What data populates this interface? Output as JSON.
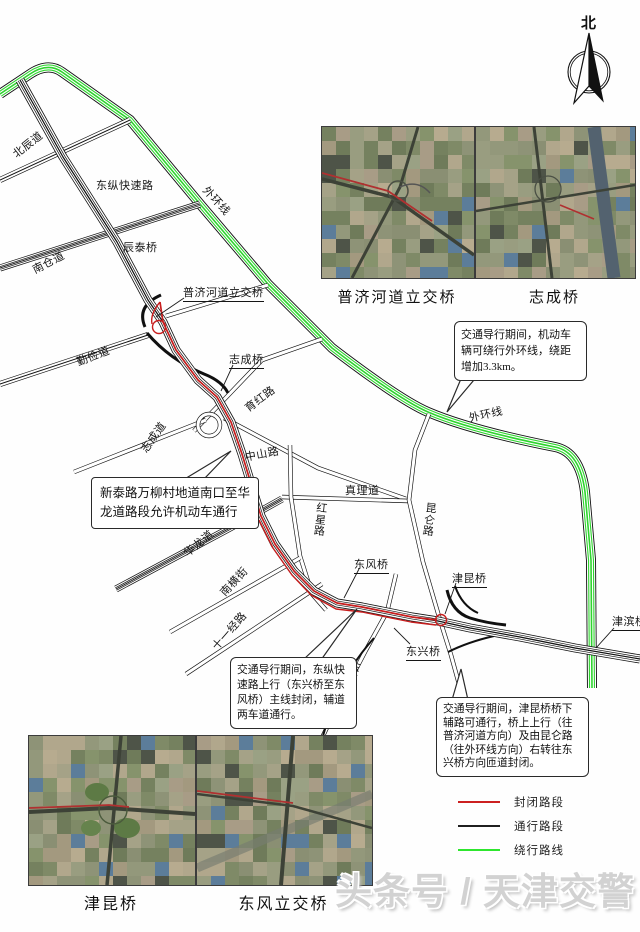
{
  "compass": {
    "north_label": "北"
  },
  "map": {
    "road_labels": [
      {
        "text": "北辰道"
      },
      {
        "text": "东纵快速路"
      },
      {
        "text": "外环线"
      },
      {
        "text": "辰泰桥"
      },
      {
        "text": "南仓道"
      },
      {
        "text": "普济河道立交桥"
      },
      {
        "text": "勤俭道"
      },
      {
        "text": "志成桥"
      },
      {
        "text": "育红路"
      },
      {
        "text": "志成道"
      },
      {
        "text": "中山路"
      },
      {
        "text": "真理道"
      },
      {
        "text": "红星路"
      },
      {
        "text": "昆仑路"
      },
      {
        "text": "华龙道"
      },
      {
        "text": "外环线"
      },
      {
        "text": "东风桥"
      },
      {
        "text": "南横街"
      },
      {
        "text": "十一经路"
      },
      {
        "text": "东兴路"
      },
      {
        "text": "东兴桥"
      },
      {
        "text": "津昆桥"
      },
      {
        "text": "津滨桥"
      }
    ],
    "route_colors": {
      "closed": "#c81e1e",
      "open": "#101010",
      "detour": "#2fd42f"
    }
  },
  "callouts": {
    "outer_ring": "交通导行期间，机动车辆可绕行外环线，绕距增加3.3km。",
    "xintai": "新泰路万柳村地道南口至华龙道路段允许机动车通行",
    "dongzong": "交通导行期间，东纵快速路上行（东兴桥至东风桥）主线封闭，辅道两车道通行。",
    "jinkun": "交通导行期间，津昆桥桥下辅路可通行，桥上上行（往普济河道方向）及由昆仑路（往外环线方向）右转往东兴桥方向匝道封闭。"
  },
  "insets_top": {
    "items": [
      {
        "label": "普济河道立交桥"
      },
      {
        "label": "志成桥"
      }
    ]
  },
  "insets_bottom": {
    "items": [
      {
        "label": "津昆桥"
      },
      {
        "label": "东风立交桥"
      }
    ]
  },
  "legend": {
    "items": [
      {
        "label": "封闭路段",
        "color": "#cc2020"
      },
      {
        "label": "通行路段",
        "color": "#1f1f1f"
      },
      {
        "label": "绕行路线",
        "color": "#2ee62e"
      }
    ]
  },
  "watermark": {
    "text": "头条号 / 天津交警"
  }
}
